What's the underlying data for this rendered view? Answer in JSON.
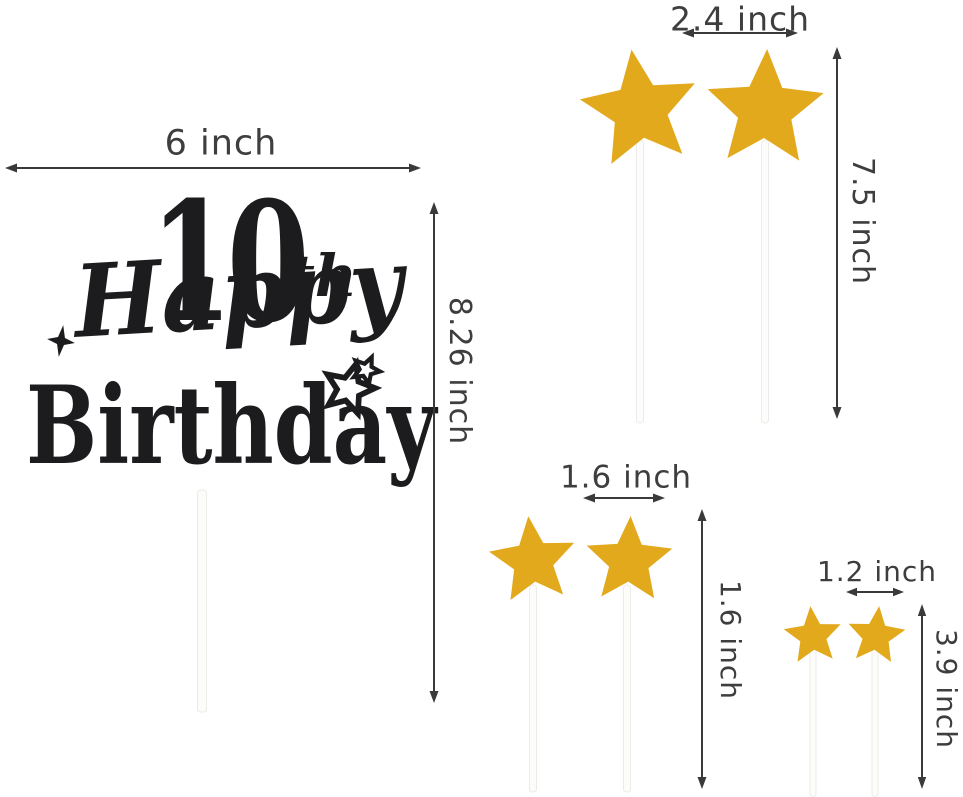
{
  "product": {
    "type": "cake-topper-dimension-diagram",
    "topper": {
      "number": "10",
      "suffix": "th",
      "word1": "Happy",
      "word2": "Birthday"
    },
    "star_counts": {
      "large": 2,
      "medium": 2,
      "small": 2
    }
  },
  "labels": {
    "topper_width": "6 inch",
    "topper_height": "8.26 inch",
    "large_star_width": "2.4 inch",
    "large_star_height": "7.5 inch",
    "medium_star_width": "1.6 inch",
    "medium_star_height": "1.6 inch",
    "small_star_width": "1.2 inch",
    "small_star_height": "3.9 inch"
  },
  "colors": {
    "gold": "#e2a91c",
    "black_glitter": "#1c1c1e",
    "dimension_line": "#3a3a3a",
    "dimension_text": "#3e3e3e",
    "stick_fill": "#fcfcfa",
    "stick_edge": "#ebebe7",
    "background": "#ffffff"
  }
}
